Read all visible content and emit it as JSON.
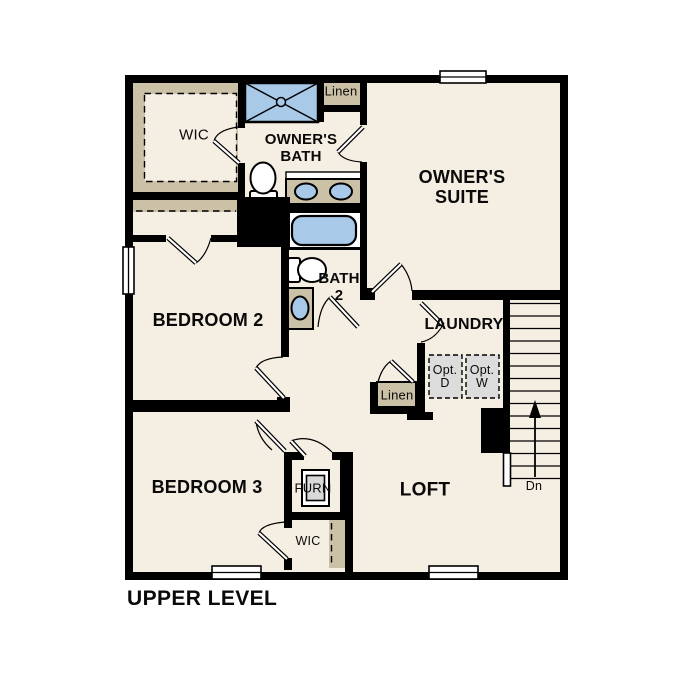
{
  "plan_title": "UPPER LEVEL",
  "colors": {
    "floor": "#F5EEE2",
    "wall": "#000000",
    "closet_shelf_tan": "#CBC1A7",
    "fixture_blue": "#A9C9E9",
    "optional_appliance_gray": "#DCDCDC",
    "background": "#FFFFFF"
  },
  "rooms": {
    "wic_top": "WIC",
    "owners_bath": "OWNER'S\nBATH",
    "linen_top": "Linen",
    "owners_suite": "OWNER'S\nSUITE",
    "bedroom_2": "BEDROOM 2",
    "bath_2": "BATH\n2",
    "laundry": "LAUNDRY",
    "opt_dryer": "Opt.\nD",
    "opt_washer": "Opt.\nW",
    "linen_mid": "Linen",
    "bedroom_3": "BEDROOM 3",
    "furnace": "FURN",
    "loft": "LOFT",
    "wic_bottom": "WIC",
    "stairs_direction": "Dn"
  }
}
